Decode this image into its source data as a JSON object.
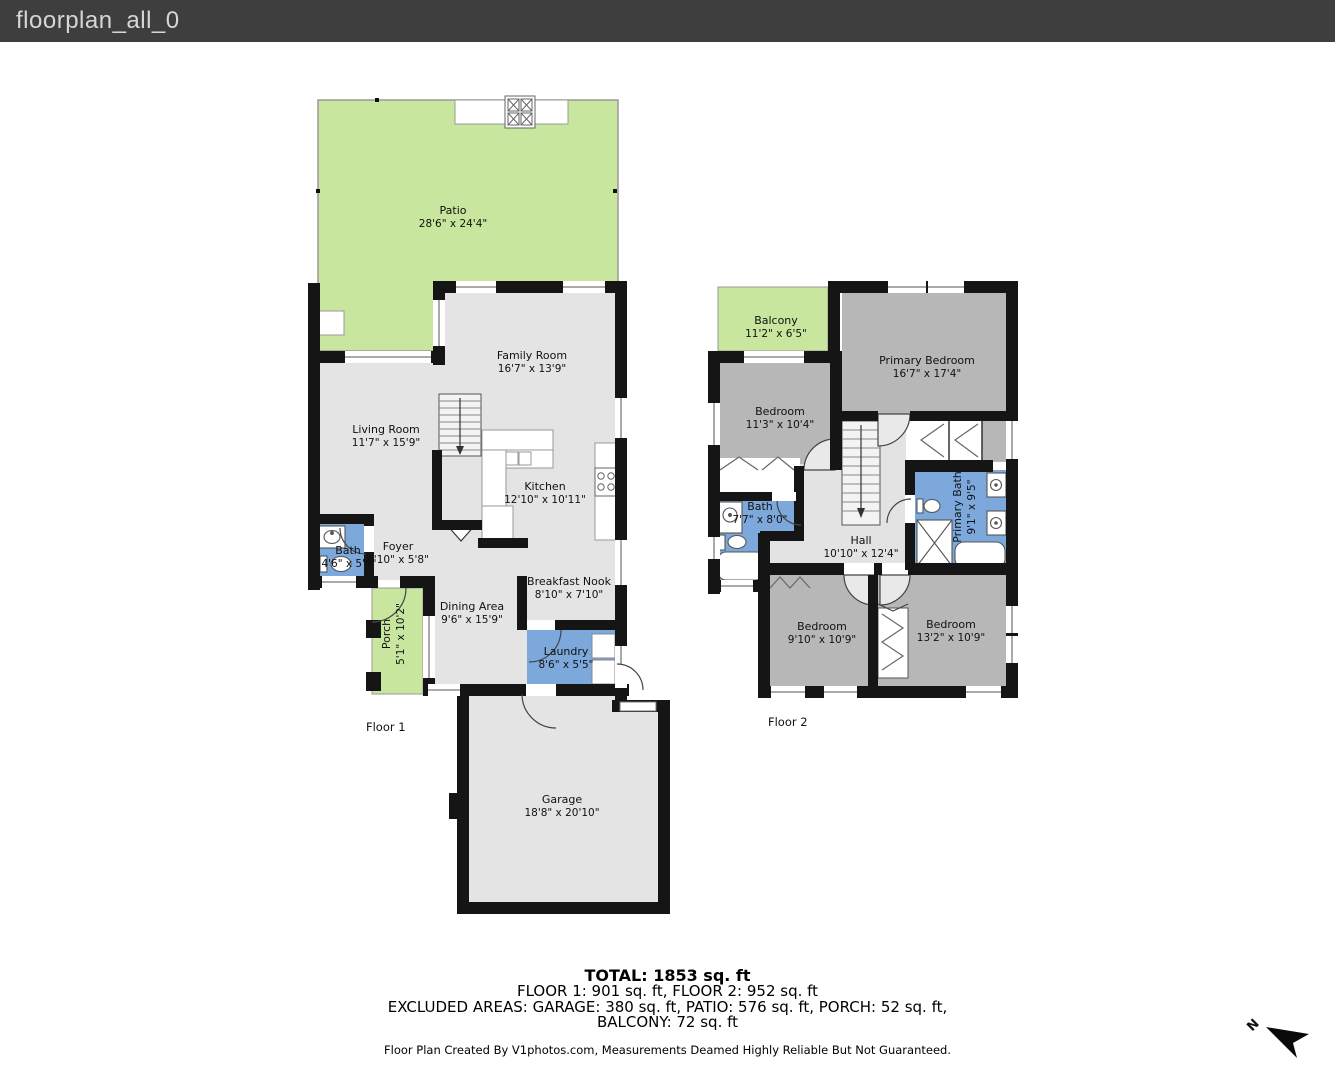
{
  "header": {
    "title": "floorplan_all_0"
  },
  "colors": {
    "header_bg": "#3e3e3e",
    "header_text": "#d6d6d6",
    "wall": "#151515",
    "floor1_fill": "#e4e4e4",
    "floor2_room": "#b7b7b7",
    "hall_fill": "#e3e3e3",
    "stairs_fill": "#f3f3f3",
    "wet_fill": "#7da8dc",
    "outdoor_fill": "#c8e69d",
    "outline": "#999999"
  },
  "floor1": {
    "label": "Floor 1",
    "rooms": {
      "patio": {
        "name": "Patio",
        "dims": "28'6\" x 24'4\""
      },
      "family": {
        "name": "Family Room",
        "dims": "16'7\" x 13'9\""
      },
      "living": {
        "name": "Living Room",
        "dims": "11'7\" x 15'9\""
      },
      "kitchen": {
        "name": "Kitchen",
        "dims": "12'10\" x 10'11\""
      },
      "foyer": {
        "name": "Foyer",
        "dims": "4'10\" x 5'8\""
      },
      "bath": {
        "name": "Bath",
        "dims": "4'6\" x 5'4\""
      },
      "porch": {
        "name": "Porch",
        "dims": "5'1\" x 10'2\""
      },
      "dining": {
        "name": "Dining Area",
        "dims": "9'6\" x 15'9\""
      },
      "nook": {
        "name": "Breakfast Nook",
        "dims": "8'10\" x 7'10\""
      },
      "laundry": {
        "name": "Laundry",
        "dims": "8'6\" x 5'5\""
      },
      "garage": {
        "name": "Garage",
        "dims": "18'8\" x 20'10\""
      }
    }
  },
  "floor2": {
    "label": "Floor 2",
    "rooms": {
      "balcony": {
        "name": "Balcony",
        "dims": "11'2\" x 6'5\""
      },
      "primary_bedroom": {
        "name": "Primary Bedroom",
        "dims": "16'7\" x 17'4\""
      },
      "bedroom_a": {
        "name": "Bedroom",
        "dims": "11'3\" x 10'4\""
      },
      "bath": {
        "name": "Bath",
        "dims": "7'7\" x 8'0\""
      },
      "primary_bath": {
        "name": "Primary Bath",
        "dims": "9'1\" x 9'5\""
      },
      "hall": {
        "name": "Hall",
        "dims": "10'10\" x 12'4\""
      },
      "bedroom_b": {
        "name": "Bedroom",
        "dims": "9'10\" x 10'9\""
      },
      "bedroom_c": {
        "name": "Bedroom",
        "dims": "13'2\" x 10'9\""
      }
    }
  },
  "summary": {
    "total": "TOTAL: 1853 sq. ft",
    "floors": "FLOOR 1: 901 sq. ft, FLOOR 2: 952 sq. ft",
    "excluded_line1": "EXCLUDED AREAS: GARAGE: 380 sq. ft, PATIO: 576 sq. ft, PORCH: 52 sq. ft,",
    "excluded_line2": "BALCONY: 72 sq. ft",
    "disclaimer": "Floor Plan Created By V1photos.com, Measurements Deamed Highly Reliable But Not Guaranteed."
  },
  "compass": {
    "label": "N"
  }
}
